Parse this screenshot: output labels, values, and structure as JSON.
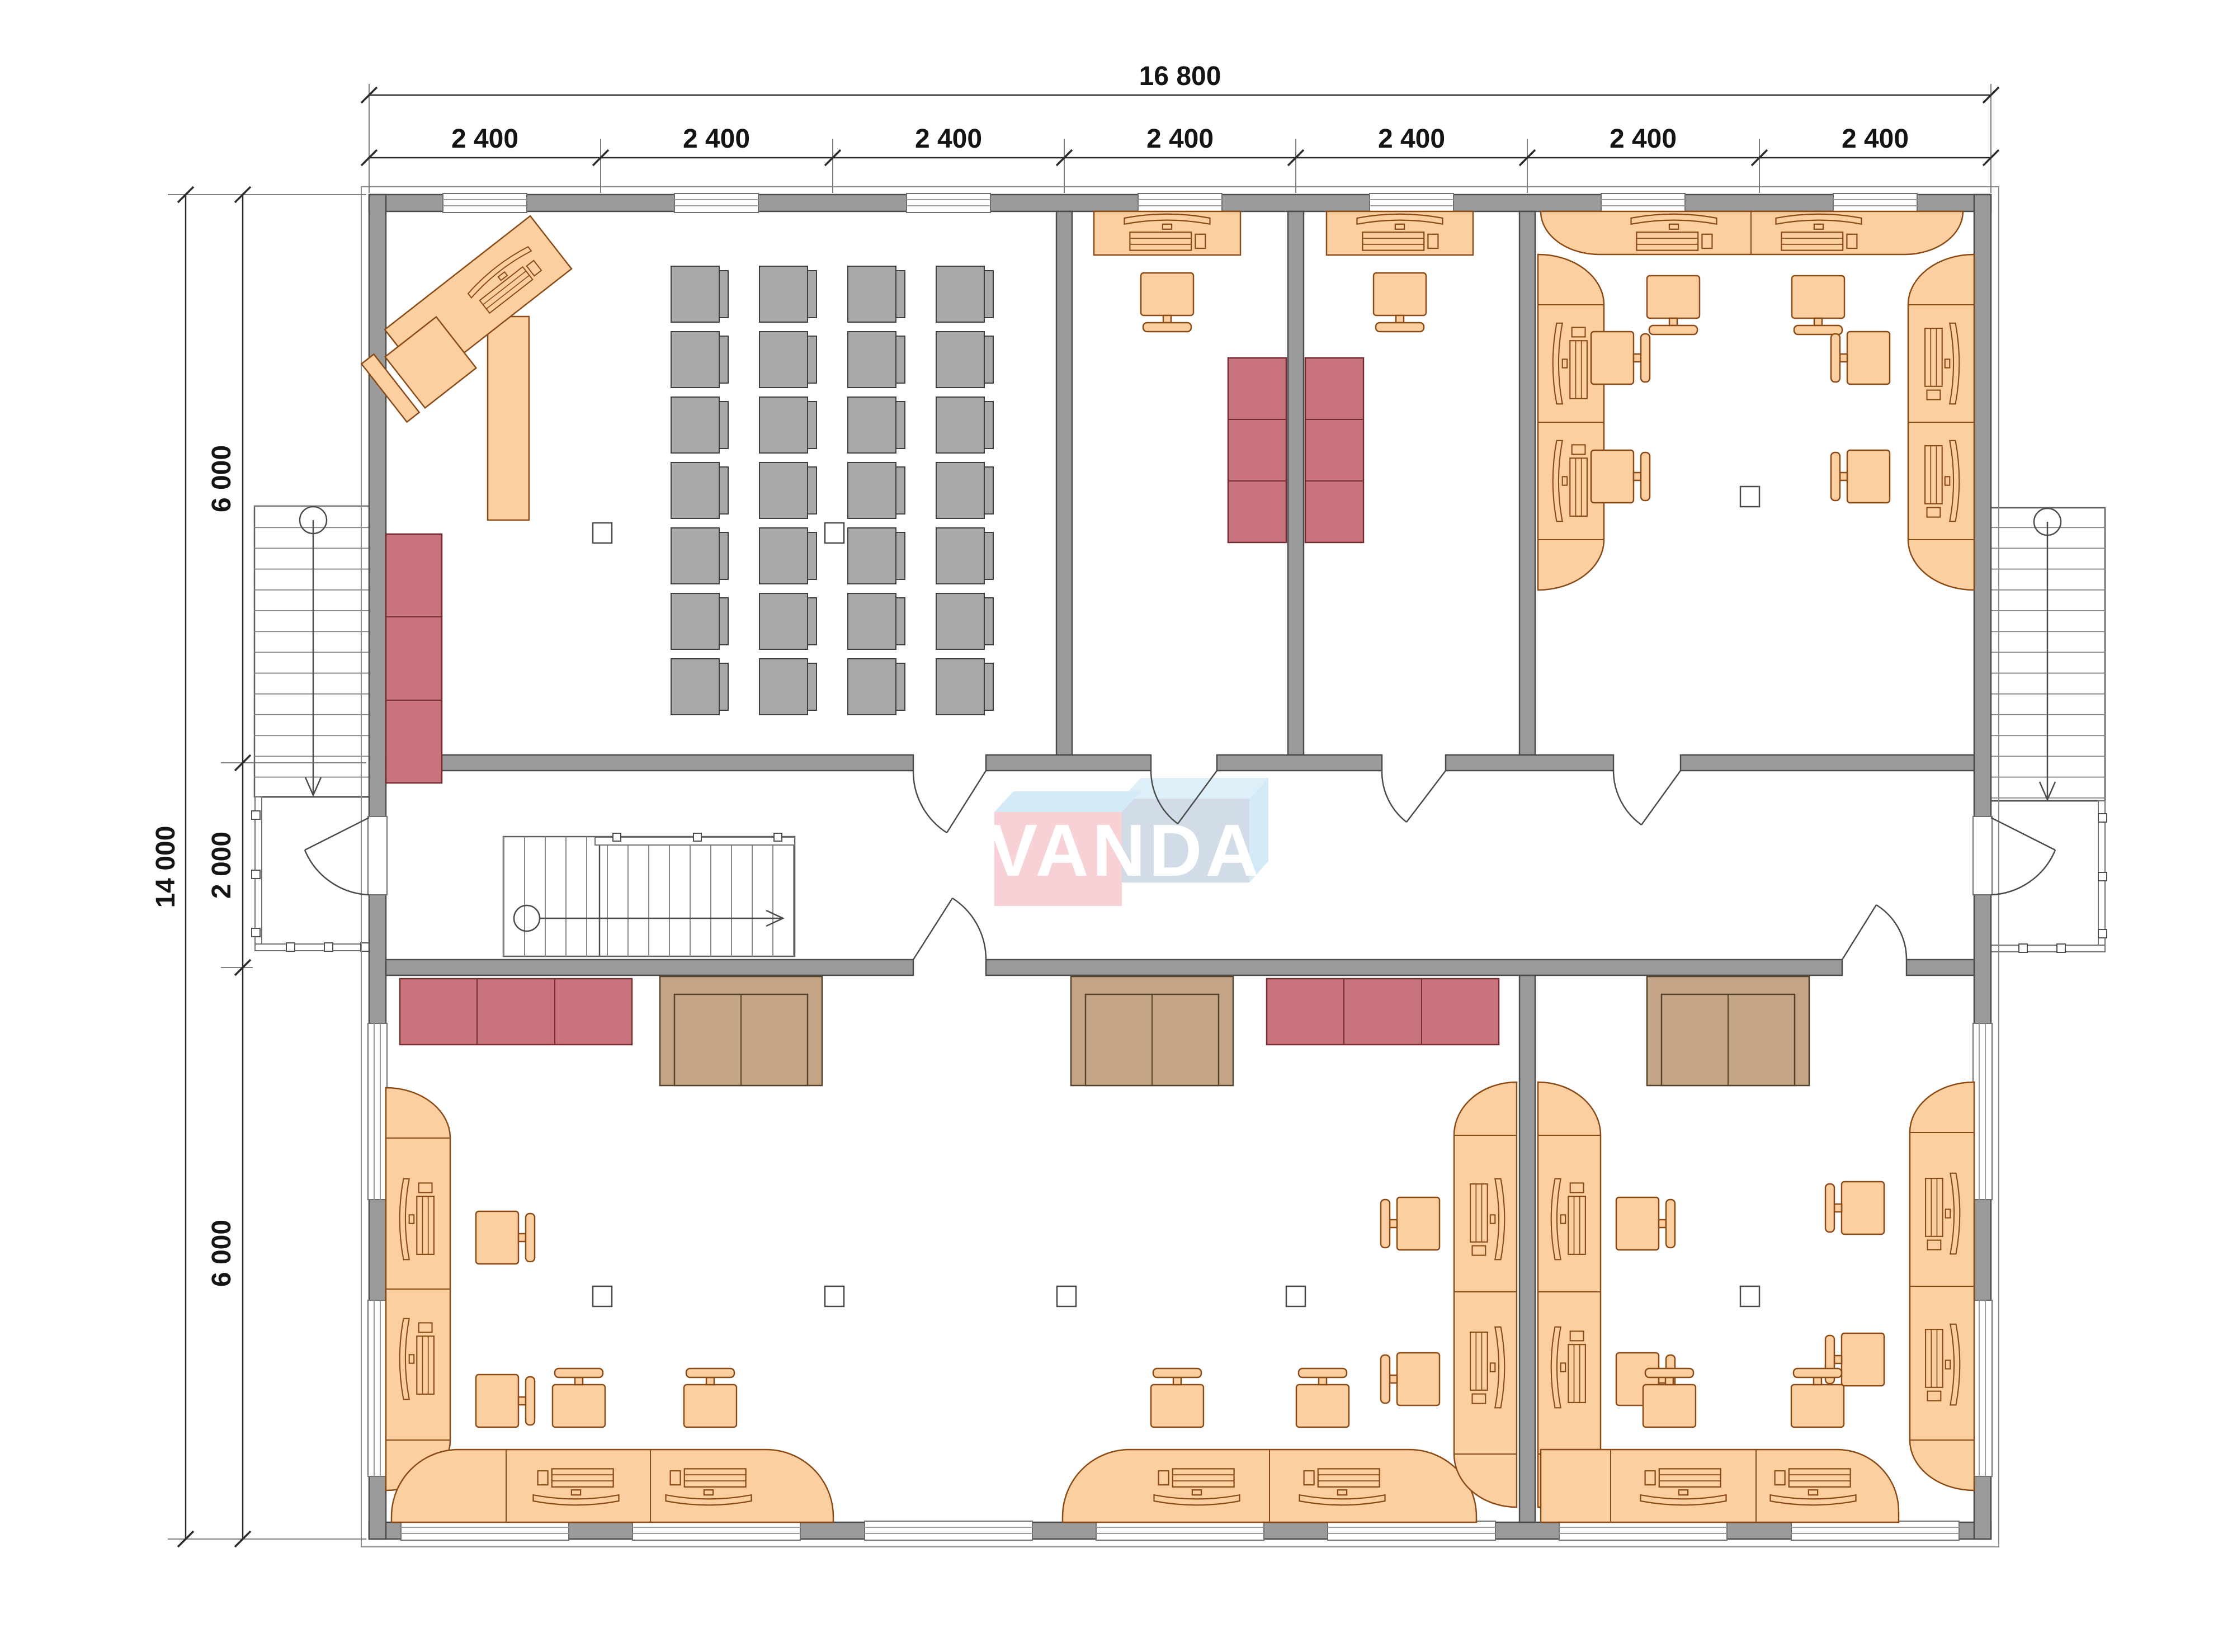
{
  "title": "office-floor-plan",
  "dimensions": {
    "top_total": "16 800",
    "top_segments": [
      "2 400",
      "2 400",
      "2 400",
      "2 400",
      "2 400",
      "2 400",
      "2 400"
    ],
    "left_total": "14 000",
    "left_segments": [
      "6 000",
      "2 000",
      "6 000"
    ]
  },
  "logo": {
    "text": "VANDA",
    "front_pink": "#f6cbd1",
    "band_light_blue": "#cfe8f5",
    "band_light_blue2": "#d9edf8",
    "front_blue_gray": "#ccd8e5",
    "letter_color": "#ffffff"
  },
  "colors": {
    "wall": "#9b9b9b",
    "desk": "#fccfa0",
    "desk_stroke": "#8a4a16",
    "chair_gray": "#a8a8a8",
    "cabinet_red": "#c9747c",
    "sofa_tan": "#c4a687",
    "dim_text": "#141414"
  }
}
